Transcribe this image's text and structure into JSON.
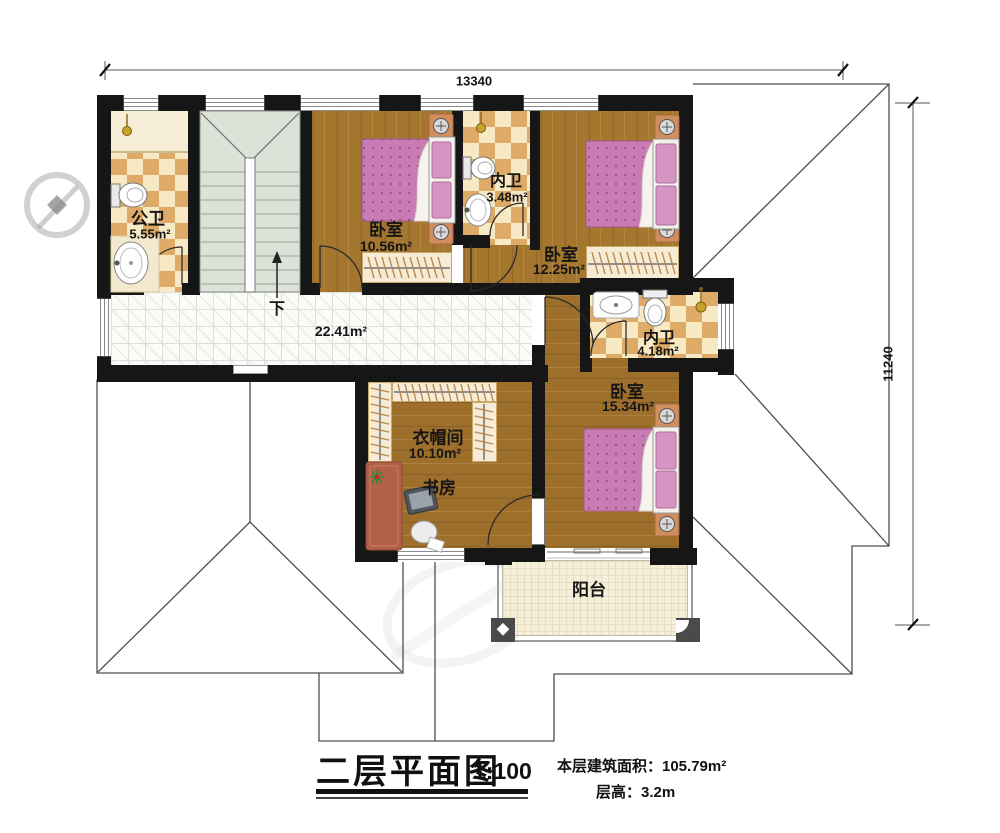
{
  "page": {
    "title_block": {
      "title": "二层平面图",
      "scale": "1:100",
      "area_note": "本层建筑面积：105.79m²",
      "height_note": "层高：3.2m"
    },
    "dimensions": {
      "top": "13340",
      "right": "11240"
    },
    "stairs": {
      "label": "下"
    },
    "hallway": {
      "area": "22.41m²"
    },
    "rooms": {
      "public_bath": {
        "name": "公卫",
        "area": "5.55m²"
      },
      "bedroom_top": {
        "name": "卧室",
        "area": "10.56m²"
      },
      "inner_bath_top": {
        "name": "内卫",
        "area": "3.48m²"
      },
      "bedroom_right": {
        "name": "卧室",
        "area": "12.25m²"
      },
      "inner_bath_mid": {
        "name": "内卫",
        "area": "4.18m²"
      },
      "bedroom_big": {
        "name": "卧室",
        "area": "15.34m²"
      },
      "cloakroom": {
        "name": "衣帽间",
        "area": "10.10m²"
      },
      "study": {
        "name": "书房"
      },
      "balcony": {
        "name": "阳台"
      }
    },
    "palette": {
      "wall": "#161616",
      "wood": "#a5762e",
      "bath_tile": "#ddab67",
      "quilt_pink": "#c87cb4",
      "stairs_green": "#dbe3d8",
      "balcony_floor": "#f5efda"
    }
  }
}
